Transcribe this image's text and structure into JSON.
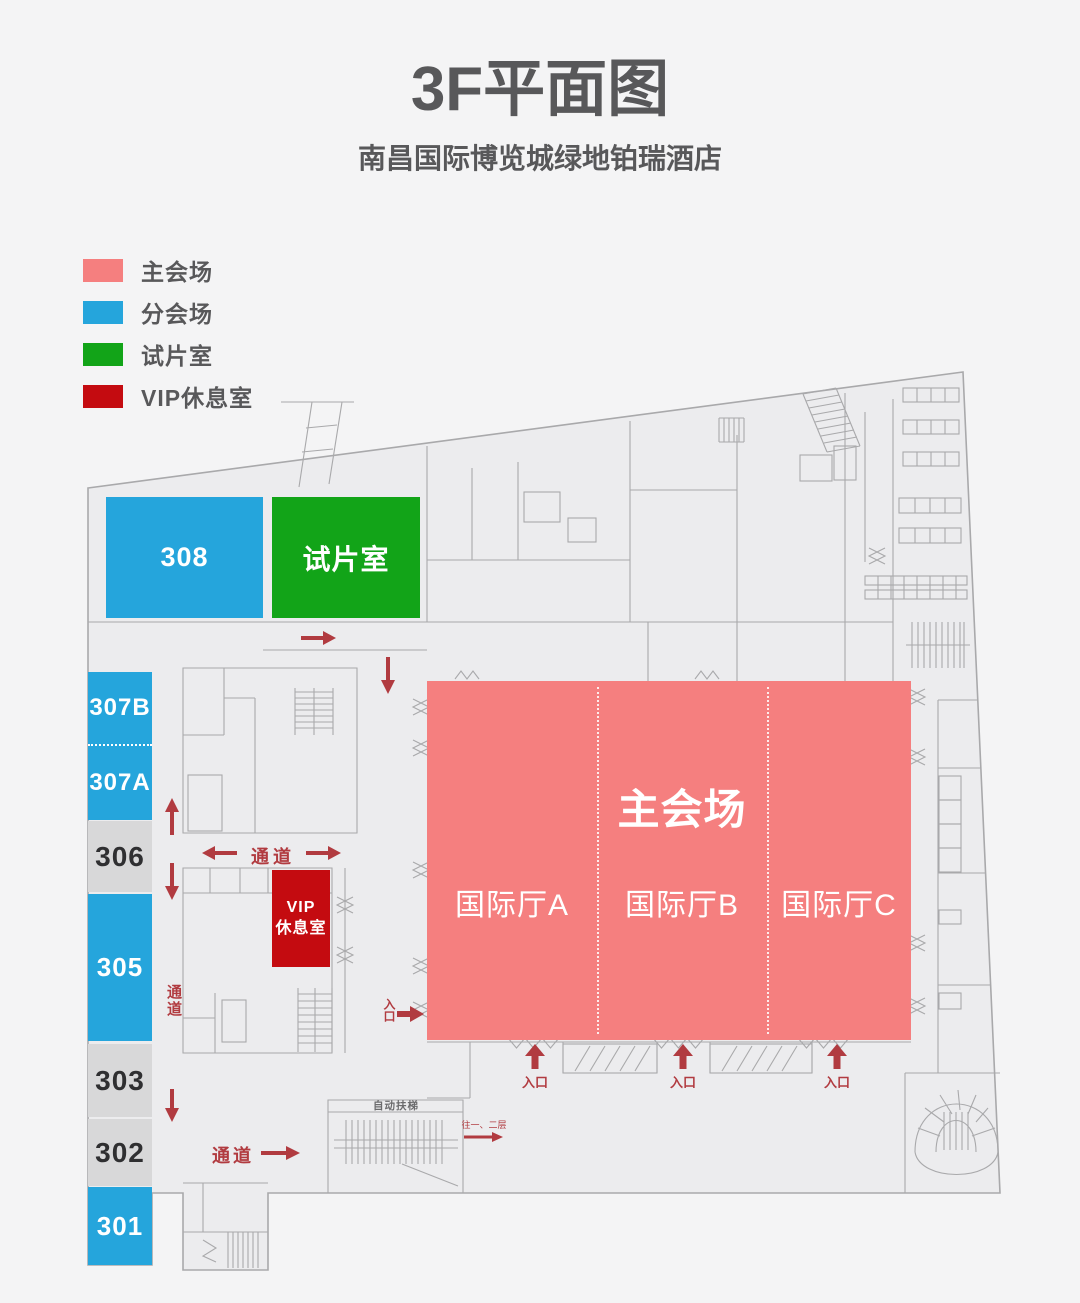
{
  "header": {
    "title": "3F平面图",
    "subtitle": "南昌国际博览城绿地铂瑞酒店"
  },
  "legend": {
    "items": [
      {
        "label": "主会场"
      },
      {
        "label": "分会场"
      },
      {
        "label": "试片室"
      },
      {
        "label": "VIP休息室"
      }
    ]
  },
  "floorplan": {
    "rooms": {
      "r308": {
        "label": "308"
      },
      "screening": {
        "label": "试片室"
      },
      "r307b": {
        "label": "307B"
      },
      "r307a": {
        "label": "307A"
      },
      "r306": {
        "label": "306"
      },
      "r305": {
        "label": "305"
      },
      "r303": {
        "label": "303"
      },
      "r302": {
        "label": "302"
      },
      "r301": {
        "label": "301"
      },
      "vip": {
        "label_line1": "VIP",
        "label_line2": "休息室"
      },
      "main_hall": {
        "label": "主会场"
      },
      "hall_a": {
        "label": "国际厅A"
      },
      "hall_b": {
        "label": "国际厅B"
      },
      "hall_c": {
        "label": "国际厅C"
      }
    },
    "annotations": {
      "corridor": "通道",
      "entrance": "入口",
      "escalator": "自动扶梯",
      "to_floors": "往一、二层"
    }
  },
  "colors": {
    "page_bg": "#f4f4f5",
    "plan_fill": "#ececee",
    "plan_line": "#a9a9ab",
    "ink": "#58585a",
    "route": "#b13b40",
    "main_venue": "#f57f7f",
    "breakout_venue": "#25a5dc",
    "screening_room": "#12a418",
    "vip_room": "#c40b10",
    "gray_room": "#d8d8d9"
  }
}
